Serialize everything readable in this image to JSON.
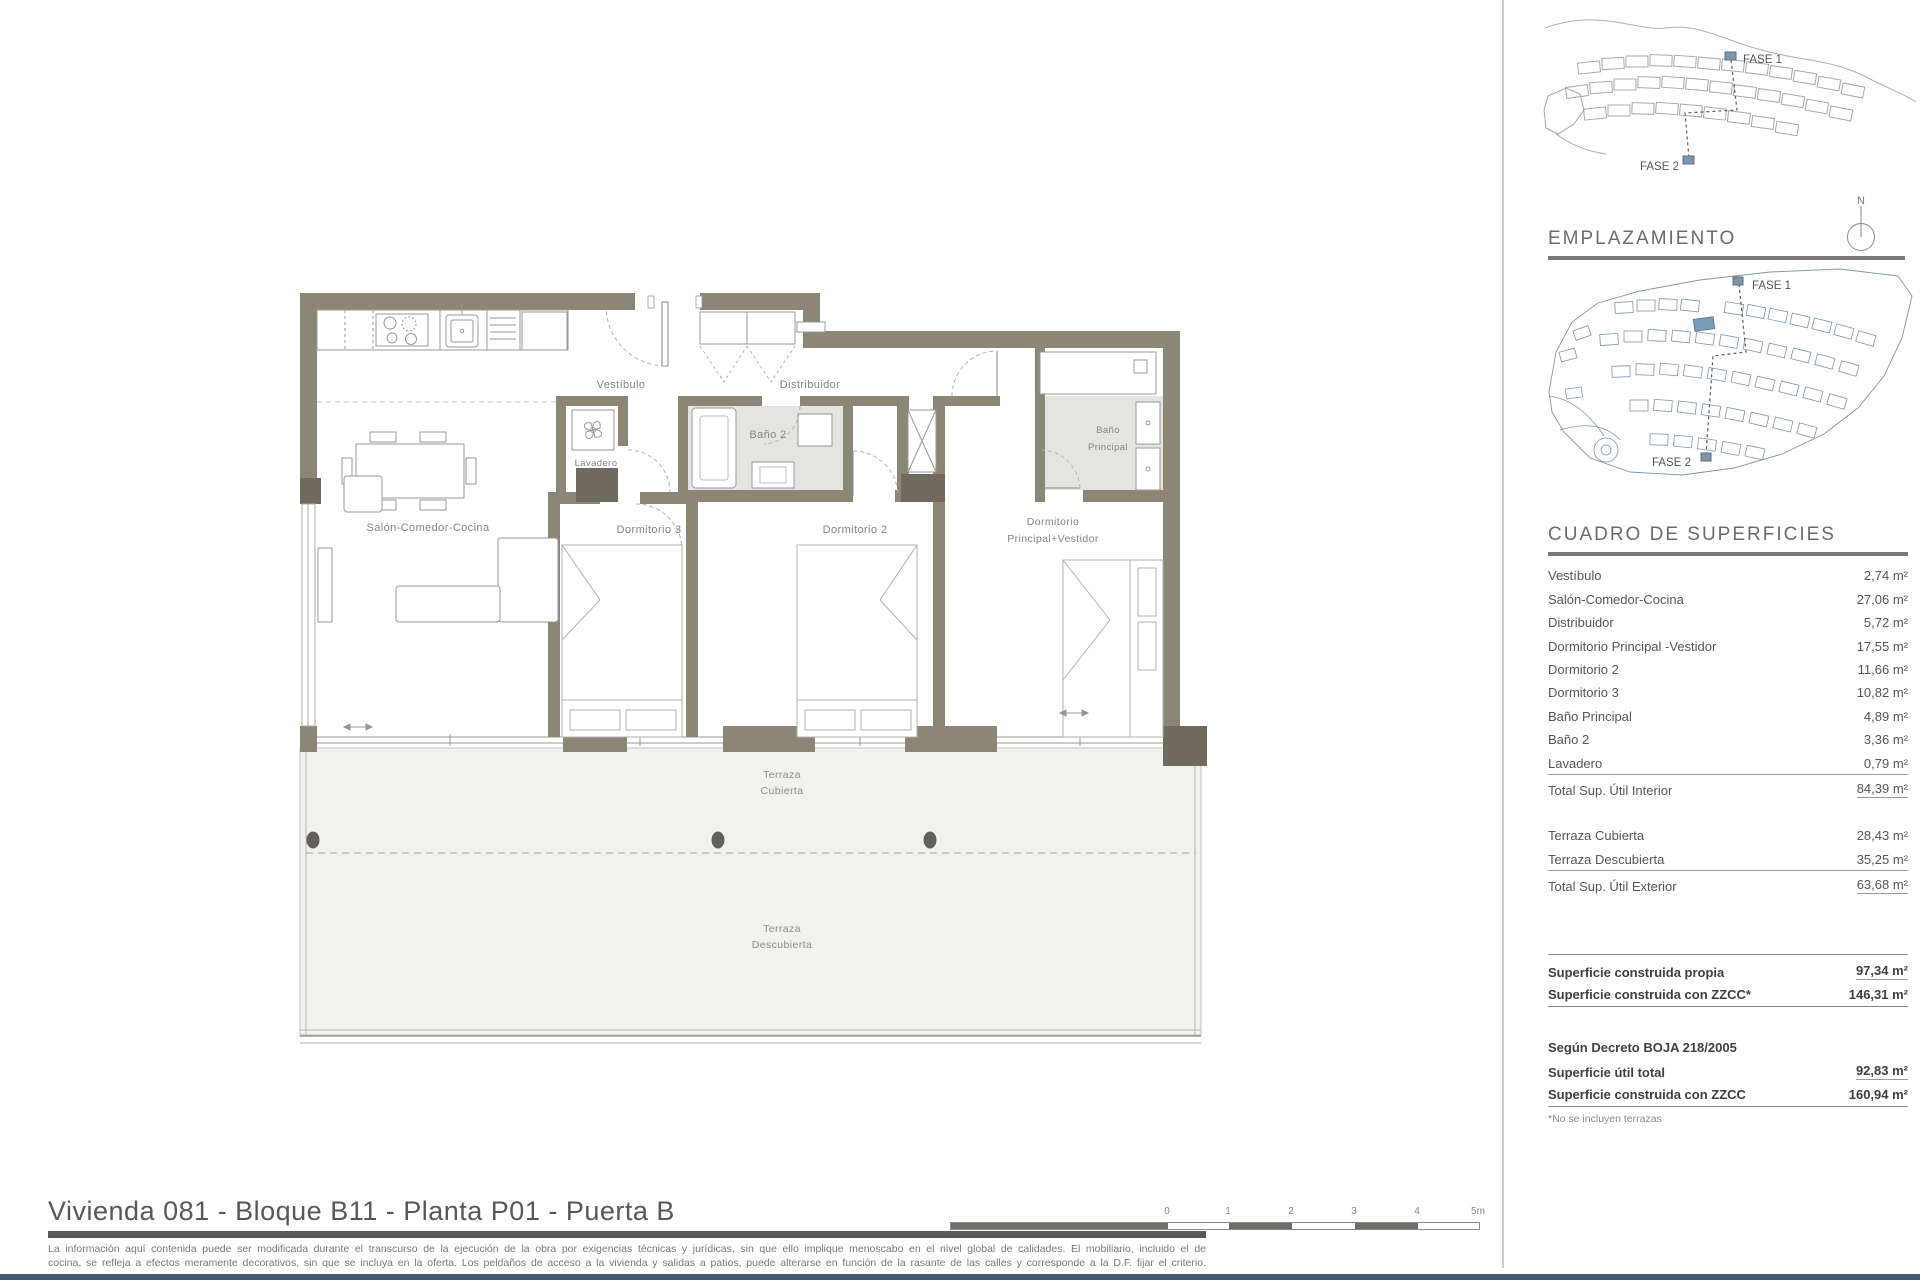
{
  "plan": {
    "labels": {
      "vestibulo": "Vestíbulo",
      "distribuidor": "Distribuidor",
      "bano2": "Baño 2",
      "lavadero": "Lavadero",
      "bano_principal_1": "Baño",
      "bano_principal_2": "Principal",
      "salon": "Salón-Comedor-Cocina",
      "dormitorio3": "Dormitorio 3",
      "dormitorio2": "Dormitorio 2",
      "dormitorio_principal_1": "Dormitorio",
      "dormitorio_principal_2": "Principal+Vestidor",
      "terraza_cubierta_1": "Terraza",
      "terraza_cubierta_2": "Cubierta",
      "terraza_descubierta_1": "Terraza",
      "terraza_descubierta_2": "Descubierta"
    }
  },
  "sidebar": {
    "fase_sketch": {
      "fase1": "FASE 1",
      "fase2": "FASE 2"
    },
    "north_label": "N",
    "emplazamiento_title": "EMPLAZAMIENTO",
    "map": {
      "fase1": "FASE 1",
      "fase2": "FASE 2"
    },
    "surfaces": {
      "title": "CUADRO DE SUPERFICIES",
      "interior_rows": [
        {
          "label": "Vestíbulo",
          "value": "2,74 m²"
        },
        {
          "label": "Salón-Comedor-Cocina",
          "value": "27,06 m²"
        },
        {
          "label": "Distribuidor",
          "value": "5,72 m²"
        },
        {
          "label": "Dormitorio Principal -Vestidor",
          "value": "17,55 m²"
        },
        {
          "label": "Dormitorio 2",
          "value": "11,66 m²"
        },
        {
          "label": "Dormitorio 3",
          "value": "10,82 m²"
        },
        {
          "label": "Baño Principal",
          "value": "4,89 m²"
        },
        {
          "label": "Baño 2",
          "value": "3,36 m²"
        },
        {
          "label": "Lavadero",
          "value": "0,79 m²"
        }
      ],
      "interior_total": {
        "label": "Total Sup. Útil Interior",
        "value": "84,39 m²"
      },
      "exterior_rows": [
        {
          "label": "Terraza Cubierta",
          "value": "28,43 m²"
        },
        {
          "label": "Terraza Descubierta",
          "value": "35,25 m²"
        }
      ],
      "exterior_total": {
        "label": "Total Sup. Útil Exterior",
        "value": "63,68 m²"
      },
      "built_rows": [
        {
          "label": "Superficie construida propia",
          "value": "97,34 m²"
        },
        {
          "label": "Superficie construida con ZZCC*",
          "value": "146,31 m²"
        }
      ],
      "decree_heading": "Según Decreto BOJA 218/2005",
      "decree_rows": [
        {
          "label": "Superficie útil total",
          "value": "92,83 m²"
        },
        {
          "label": "Superficie construida con ZZCC",
          "value": "160,94 m²"
        }
      ],
      "footnote": "*No se incluyen terrazas"
    }
  },
  "footer": {
    "title": "Vivienda 081 - Bloque B11 - Planta P01 - Puerta B",
    "disclaimer_line1": "La información aquí contenida puede ser modificada durante el transcurso de la ejecución de la obra por exigencias técnicas y jurídicas, sin que ello implique menoscabo en el nivel global de calidades. El mobiliario, incluido el de",
    "disclaimer_line2": "cocina, se refleja a efectos meramente decorativos, sin que se incluya en la oferta. Los peldaños de acceso a la vivienda y salidas a patios, puede alterarse en función de la rasante de las calles y corresponde a la D.F. fijar el criterio.",
    "scale_ticks": {
      "t0": "0",
      "t1": "1",
      "t2": "2",
      "t3": "3",
      "t4": "4",
      "t5": "5m"
    }
  },
  "colors": {
    "wall": "#8c8677",
    "wall_dark": "#6f6a5e",
    "accent_blue": "#7b9cb8",
    "bottom_bar": "#47596c"
  }
}
